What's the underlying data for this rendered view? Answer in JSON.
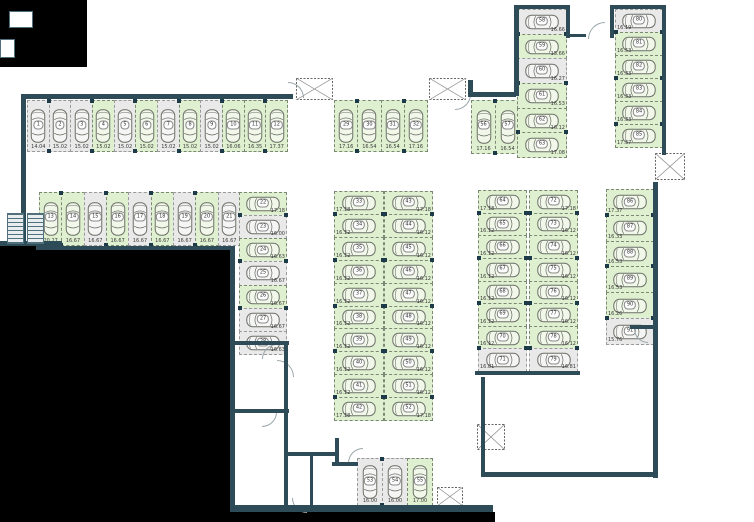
{
  "app": {
    "title": "Parking level floor plan"
  },
  "legend": {
    "free_color": "#dff0d0",
    "occupied_color": "#e9e9e9",
    "wall_color": "#2e4b58",
    "outside_color": "#000000"
  },
  "icons": {
    "stairs": "stairs-icon",
    "shaft": "crossed-shaft-icon",
    "door": "door-swing-icon",
    "car": "car-top-view-icon"
  },
  "parking": {
    "groups": [
      {
        "id": "g1",
        "name": "top-left-row",
        "spaces": [
          {
            "num": "1",
            "size": "14.04",
            "free": false
          },
          {
            "num": "2",
            "size": "15.02",
            "free": false
          },
          {
            "num": "3",
            "size": "15.02",
            "free": false
          },
          {
            "num": "4",
            "size": "15.02",
            "free": true
          },
          {
            "num": "5",
            "size": "15.02",
            "free": false
          },
          {
            "num": "6",
            "size": "15.02",
            "free": true
          },
          {
            "num": "7",
            "size": "15.02",
            "free": false
          },
          {
            "num": "8",
            "size": "15.02",
            "free": true
          },
          {
            "num": "9",
            "size": "15.02",
            "free": false
          },
          {
            "num": "10",
            "size": "16.06",
            "free": true
          },
          {
            "num": "11",
            "size": "16.35",
            "free": true
          },
          {
            "num": "12",
            "size": "17.37",
            "free": true
          }
        ]
      },
      {
        "id": "g2",
        "name": "second-row",
        "spaces": [
          {
            "num": "13",
            "size": "20.27",
            "free": true
          },
          {
            "num": "14",
            "size": "16.67",
            "free": true
          },
          {
            "num": "15",
            "size": "16.67",
            "free": false
          },
          {
            "num": "16",
            "size": "16.67",
            "free": true
          },
          {
            "num": "17",
            "size": "16.67",
            "free": false
          },
          {
            "num": "18",
            "size": "16.67",
            "free": true
          },
          {
            "num": "19",
            "size": "16.67",
            "free": false
          },
          {
            "num": "20",
            "size": "16.67",
            "free": true
          },
          {
            "num": "21",
            "size": "16.67",
            "free": false
          }
        ]
      },
      {
        "id": "g3",
        "name": "left-column",
        "spaces": [
          {
            "num": "22",
            "size": "17.18",
            "free": true
          },
          {
            "num": "23",
            "size": "16.00",
            "free": false
          },
          {
            "num": "24",
            "size": "16.63",
            "free": true
          },
          {
            "num": "25",
            "size": "16.67",
            "free": false
          },
          {
            "num": "26",
            "size": "16.67",
            "free": true
          },
          {
            "num": "27",
            "size": "16.67",
            "free": false
          },
          {
            "num": "28",
            "size": "16.63",
            "free": false
          }
        ]
      },
      {
        "id": "g4",
        "name": "top-middle-row",
        "spaces": [
          {
            "num": "29",
            "size": "17.16",
            "free": true
          },
          {
            "num": "30",
            "size": "16.54",
            "free": true
          },
          {
            "num": "31",
            "size": "16.54",
            "free": true
          },
          {
            "num": "32",
            "size": "17.16",
            "free": true
          }
        ]
      },
      {
        "id": "g5L",
        "name": "center-block-left-column",
        "spaces": [
          {
            "num": "33",
            "size": "17.18",
            "free": true
          },
          {
            "num": "34",
            "size": "16.12",
            "free": true
          },
          {
            "num": "35",
            "size": "16.12",
            "free": true
          },
          {
            "num": "36",
            "size": "16.12",
            "free": true
          },
          {
            "num": "37",
            "size": "16.12",
            "free": true
          },
          {
            "num": "38",
            "size": "16.12",
            "free": true
          },
          {
            "num": "39",
            "size": "16.12",
            "free": true
          },
          {
            "num": "40",
            "size": "16.12",
            "free": true
          },
          {
            "num": "41",
            "size": "16.12",
            "free": true
          },
          {
            "num": "42",
            "size": "17.18",
            "free": true
          }
        ]
      },
      {
        "id": "g5R",
        "name": "center-block-right-column",
        "spaces": [
          {
            "num": "43",
            "size": "17.18",
            "free": true
          },
          {
            "num": "44",
            "size": "16.12",
            "free": true
          },
          {
            "num": "45",
            "size": "16.12",
            "free": true
          },
          {
            "num": "46",
            "size": "16.12",
            "free": true
          },
          {
            "num": "47",
            "size": "16.12",
            "free": true
          },
          {
            "num": "48",
            "size": "16.12",
            "free": true
          },
          {
            "num": "49",
            "size": "16.12",
            "free": true
          },
          {
            "num": "50",
            "size": "16.12",
            "free": true
          },
          {
            "num": "51",
            "size": "16.12",
            "free": true
          },
          {
            "num": "52",
            "size": "17.18",
            "free": true
          }
        ]
      },
      {
        "id": "g6",
        "name": "bottom-middle-row",
        "spaces": [
          {
            "num": "53",
            "size": "16.00",
            "free": false
          },
          {
            "num": "54",
            "size": "16.00",
            "free": false
          },
          {
            "num": "55",
            "size": "17.00",
            "free": true
          }
        ]
      },
      {
        "id": "g7",
        "name": "middle-pair",
        "spaces": [
          {
            "num": "56",
            "size": "17.16",
            "free": true
          },
          {
            "num": "57",
            "size": "16.54",
            "free": true
          }
        ]
      },
      {
        "id": "g8",
        "name": "top-right-left-column",
        "spaces": [
          {
            "num": "58",
            "size": "16.66",
            "free": false
          },
          {
            "num": "59",
            "size": "15.66",
            "free": true
          },
          {
            "num": "60",
            "size": "16.27",
            "free": false
          },
          {
            "num": "61",
            "size": "16.53",
            "free": true
          },
          {
            "num": "62",
            "size": "16.12",
            "free": true
          },
          {
            "num": "63",
            "size": "17.08",
            "free": true
          }
        ]
      },
      {
        "id": "g9L",
        "name": "right-block-left-column",
        "spaces": [
          {
            "num": "64",
            "size": "17.18",
            "free": true
          },
          {
            "num": "65",
            "size": "16.12",
            "free": true
          },
          {
            "num": "66",
            "size": "16.12",
            "free": true
          },
          {
            "num": "67",
            "size": "16.12",
            "free": true
          },
          {
            "num": "68",
            "size": "16.12",
            "free": true
          },
          {
            "num": "69",
            "size": "16.12",
            "free": true
          },
          {
            "num": "70",
            "size": "16.12",
            "free": true
          },
          {
            "num": "71",
            "size": "16.81",
            "free": false
          }
        ]
      },
      {
        "id": "g9R",
        "name": "right-block-right-column",
        "spaces": [
          {
            "num": "72",
            "size": "17.18",
            "free": true
          },
          {
            "num": "73",
            "size": "16.12",
            "free": true
          },
          {
            "num": "74",
            "size": "16.12",
            "free": true
          },
          {
            "num": "75",
            "size": "16.12",
            "free": true
          },
          {
            "num": "76",
            "size": "16.12",
            "free": true
          },
          {
            "num": "77",
            "size": "16.12",
            "free": true
          },
          {
            "num": "78",
            "size": "16.12",
            "free": true
          },
          {
            "num": "79",
            "size": "16.81",
            "free": false
          }
        ]
      },
      {
        "id": "g10",
        "name": "top-right-outer-column",
        "spaces": [
          {
            "num": "80",
            "size": "16.19",
            "free": false
          },
          {
            "num": "81",
            "size": "16.53",
            "free": true
          },
          {
            "num": "82",
            "size": "16.33",
            "free": true
          },
          {
            "num": "83",
            "size": "16.33",
            "free": true
          },
          {
            "num": "84",
            "size": "16.33",
            "free": true
          },
          {
            "num": "85",
            "size": "17.37",
            "free": true
          }
        ]
      },
      {
        "id": "g11",
        "name": "right-edge-column",
        "spaces": [
          {
            "num": "86",
            "size": "17.37",
            "free": true
          },
          {
            "num": "87",
            "size": "16.33",
            "free": true
          },
          {
            "num": "88",
            "size": "16.53",
            "free": true
          },
          {
            "num": "89",
            "size": "16.53",
            "free": true
          },
          {
            "num": "90",
            "size": "16.26",
            "free": true
          },
          {
            "num": "91",
            "size": "15.76",
            "free": false
          }
        ]
      }
    ]
  }
}
